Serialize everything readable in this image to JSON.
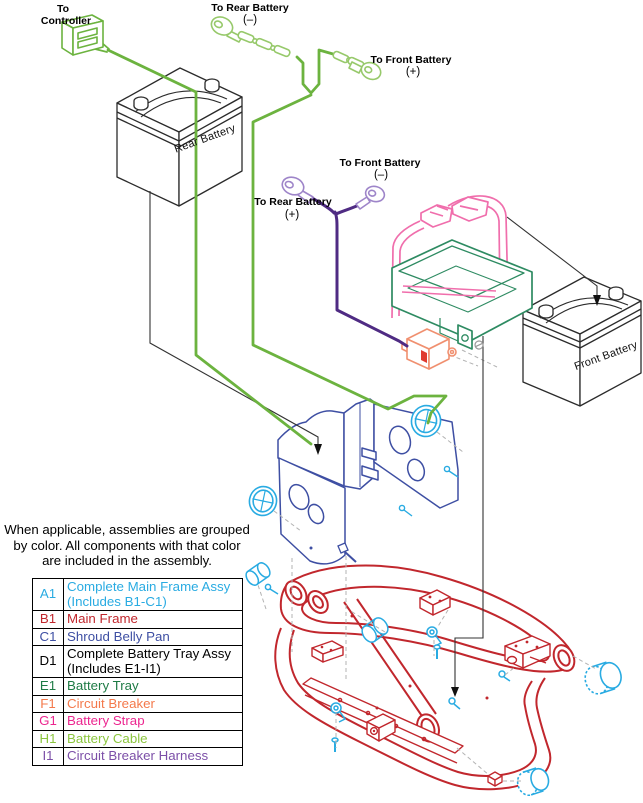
{
  "colors": {
    "cyan": "#29ABE2",
    "red": "#C1272D",
    "blue": "#3E4FA3",
    "black": "#000000",
    "dark_green": "#1E7B45",
    "tray_green": "#2E8B62",
    "orange": "#F4794B",
    "breaker_salmon": "#F09070",
    "magenta": "#EC268F",
    "strap_pink": "#F06EAC",
    "yellow_green": "#8CC63F",
    "cable_green": "#6CB33F",
    "cable_green_light": "#97C96B",
    "purple": "#7C4FA8",
    "harness_purple": "#4F2B83",
    "harness_purple_light": "#9E85C9"
  },
  "diagram_labels": {
    "to_controller": {
      "line1": "To",
      "line2": "Controller"
    },
    "to_rear_battery_neg": {
      "line1": "To Rear Battery",
      "line2": "(–)"
    },
    "to_front_battery_pos": {
      "line1": "To Front Battery",
      "line2": "(+)"
    },
    "to_front_battery_neg": {
      "line1": "To Front Battery",
      "line2": "(–)"
    },
    "to_rear_battery_pos": {
      "line1": "To Rear Battery",
      "line2": "(+)"
    },
    "rear_battery": "Rear Battery",
    "front_battery": "Front Battery"
  },
  "note": {
    "line1": "When applicable, assemblies are grouped",
    "line2": "by color. All components with that color",
    "line3": "are included in the assembly."
  },
  "legend": {
    "rows": [
      {
        "code": "A1",
        "label": "Complete Main Frame Assy",
        "label2": "(Includes B1-C1)",
        "color": "#29ABE2"
      },
      {
        "code": "B1",
        "label": "Main Frame",
        "color": "#C1272D"
      },
      {
        "code": "C1",
        "label": "Shroud Belly Pan",
        "color": "#3E4FA3"
      },
      {
        "code": "D1",
        "label": "Complete Battery Tray Assy",
        "label2": "(Includes E1-I1)",
        "color": "#000000"
      },
      {
        "code": "E1",
        "label": "Battery Tray",
        "color": "#1E7B45"
      },
      {
        "code": "F1",
        "label": "Circuit Breaker",
        "color": "#F4794B"
      },
      {
        "code": "G1",
        "label": "Battery Strap",
        "color": "#EC268F"
      },
      {
        "code": "H1",
        "label": "Battery Cable",
        "color": "#8CC63F"
      },
      {
        "code": "I1",
        "label": "Circuit Breaker Harness",
        "color": "#7C4FA8"
      }
    ]
  }
}
